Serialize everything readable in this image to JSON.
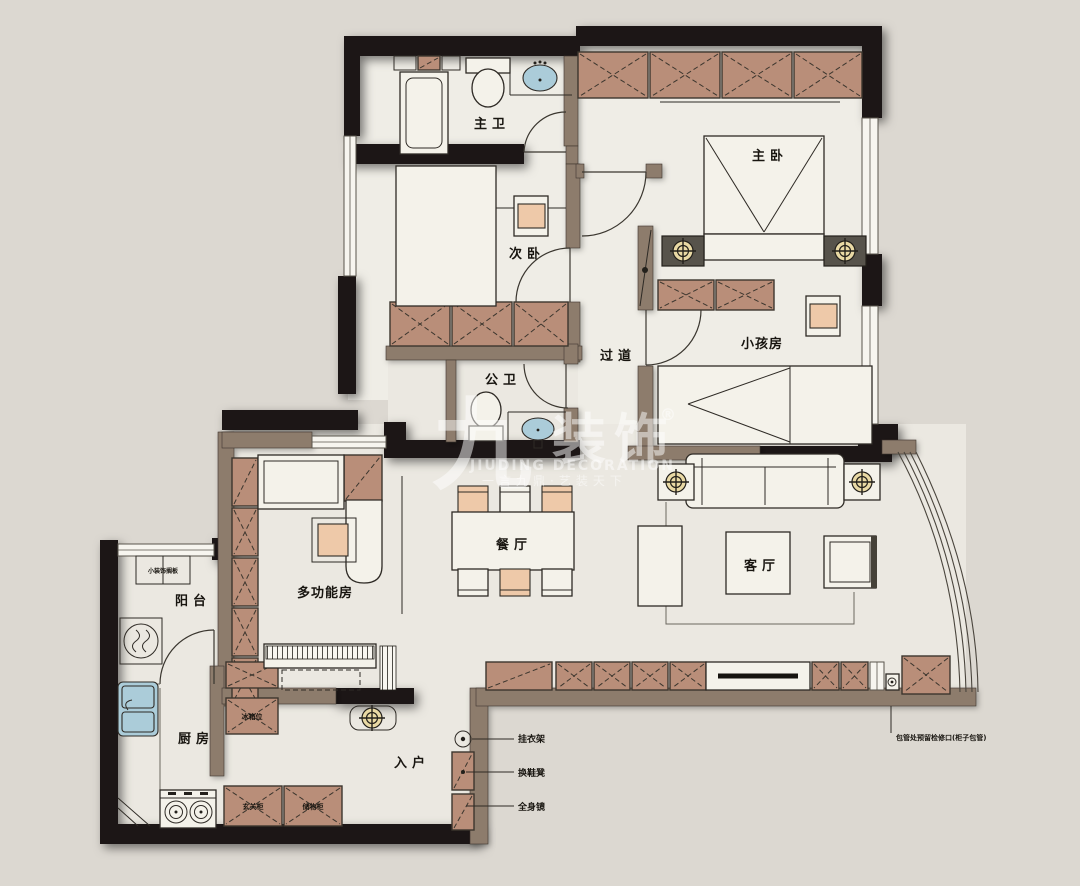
{
  "colors": {
    "background": "#dcd8d1",
    "floor": "#ebe8e1",
    "wall_black": "#1b1812",
    "wall_brown": "#8d7b6c",
    "cabinet_brown": "#b98e79",
    "accent_peach": "#eec9a9",
    "sink_blue": "#abccd9",
    "lamp_glow": "#e9d9a4"
  },
  "rooms": {
    "master_bath": "主卫",
    "master_bedroom": "主卧",
    "second_bedroom": "次卧",
    "hallway": "过道",
    "kids_room": "小孩房",
    "public_bath": "公卫",
    "dining_room": "餐厅",
    "living_room": "客厅",
    "multi_function_room": "多功能房",
    "balcony": "阳台",
    "kitchen": "厨房",
    "entry": "入户"
  },
  "annotations": {
    "coat_rack": "挂衣架",
    "shoe_bench": "换鞋凳",
    "full_length_mirror": "全身镜",
    "pipe_note": "包管处预留检修口(柜子包管)",
    "balcony_shelf": "小装饰搁板",
    "fridge_spot": "冰箱位",
    "entry_cabinet": "玄关柜",
    "storage_cabinet": "储物柜"
  },
  "watermark": {
    "logo_glyph": "九",
    "brand": "装饰",
    "registered_mark": "®",
    "english_name": "JIUDING DECORATION",
    "tagline": "一言九鼎·艺装天下"
  }
}
